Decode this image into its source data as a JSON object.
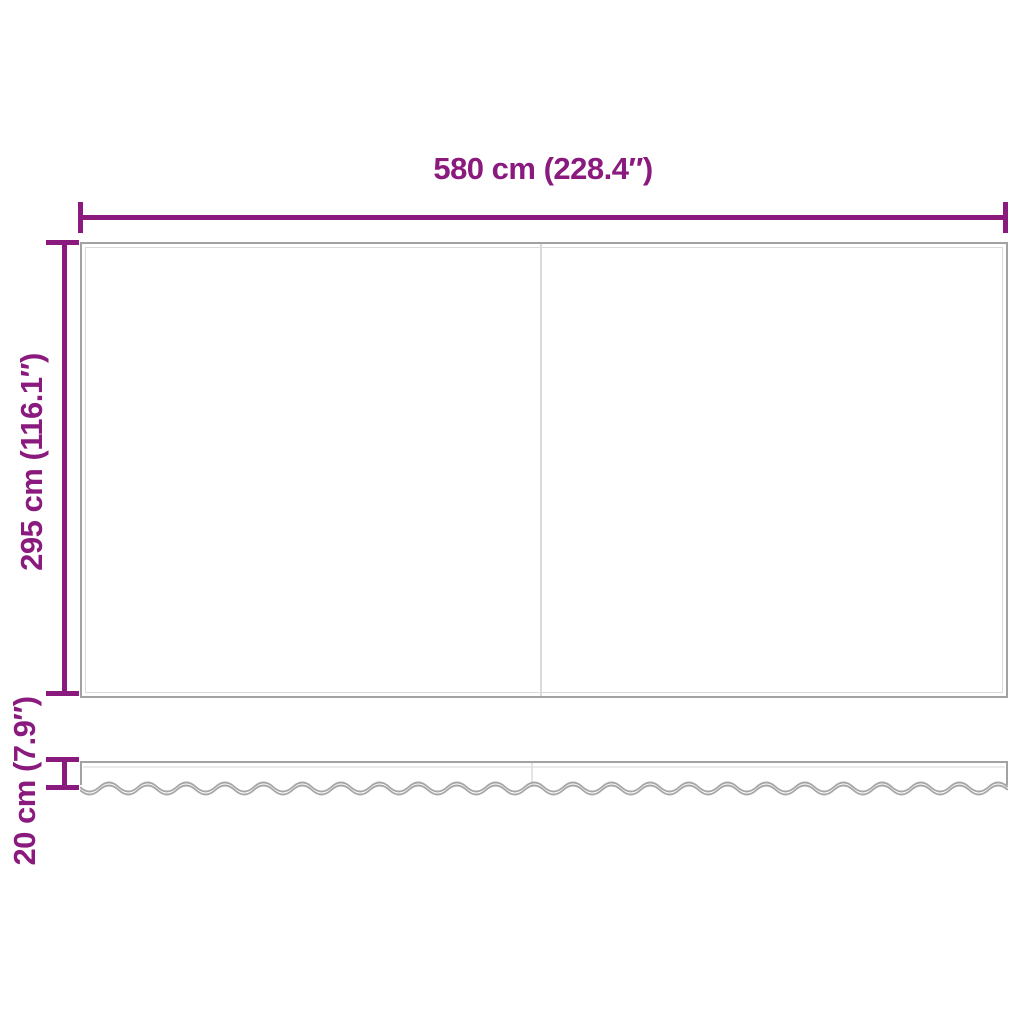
{
  "diagram": {
    "type": "product-dimension-diagram",
    "subject": "awning-replacement-fabric-with-valance",
    "background_color": "#FFFFFF",
    "accent_color": "#8A1A7D",
    "outline_color": "#A2A2A2",
    "inner_seam_color": "#DADADA",
    "dimensions": {
      "width": {
        "label": "580 cm (228.4″)",
        "value_cm": 580,
        "value_in": 228.4
      },
      "height": {
        "label": "295 cm (116.1″)",
        "value_cm": 295,
        "value_in": 116.1
      },
      "valance_height": {
        "label": "20 cm (7.9″)",
        "value_cm": 20,
        "value_in": 7.9
      }
    }
  }
}
